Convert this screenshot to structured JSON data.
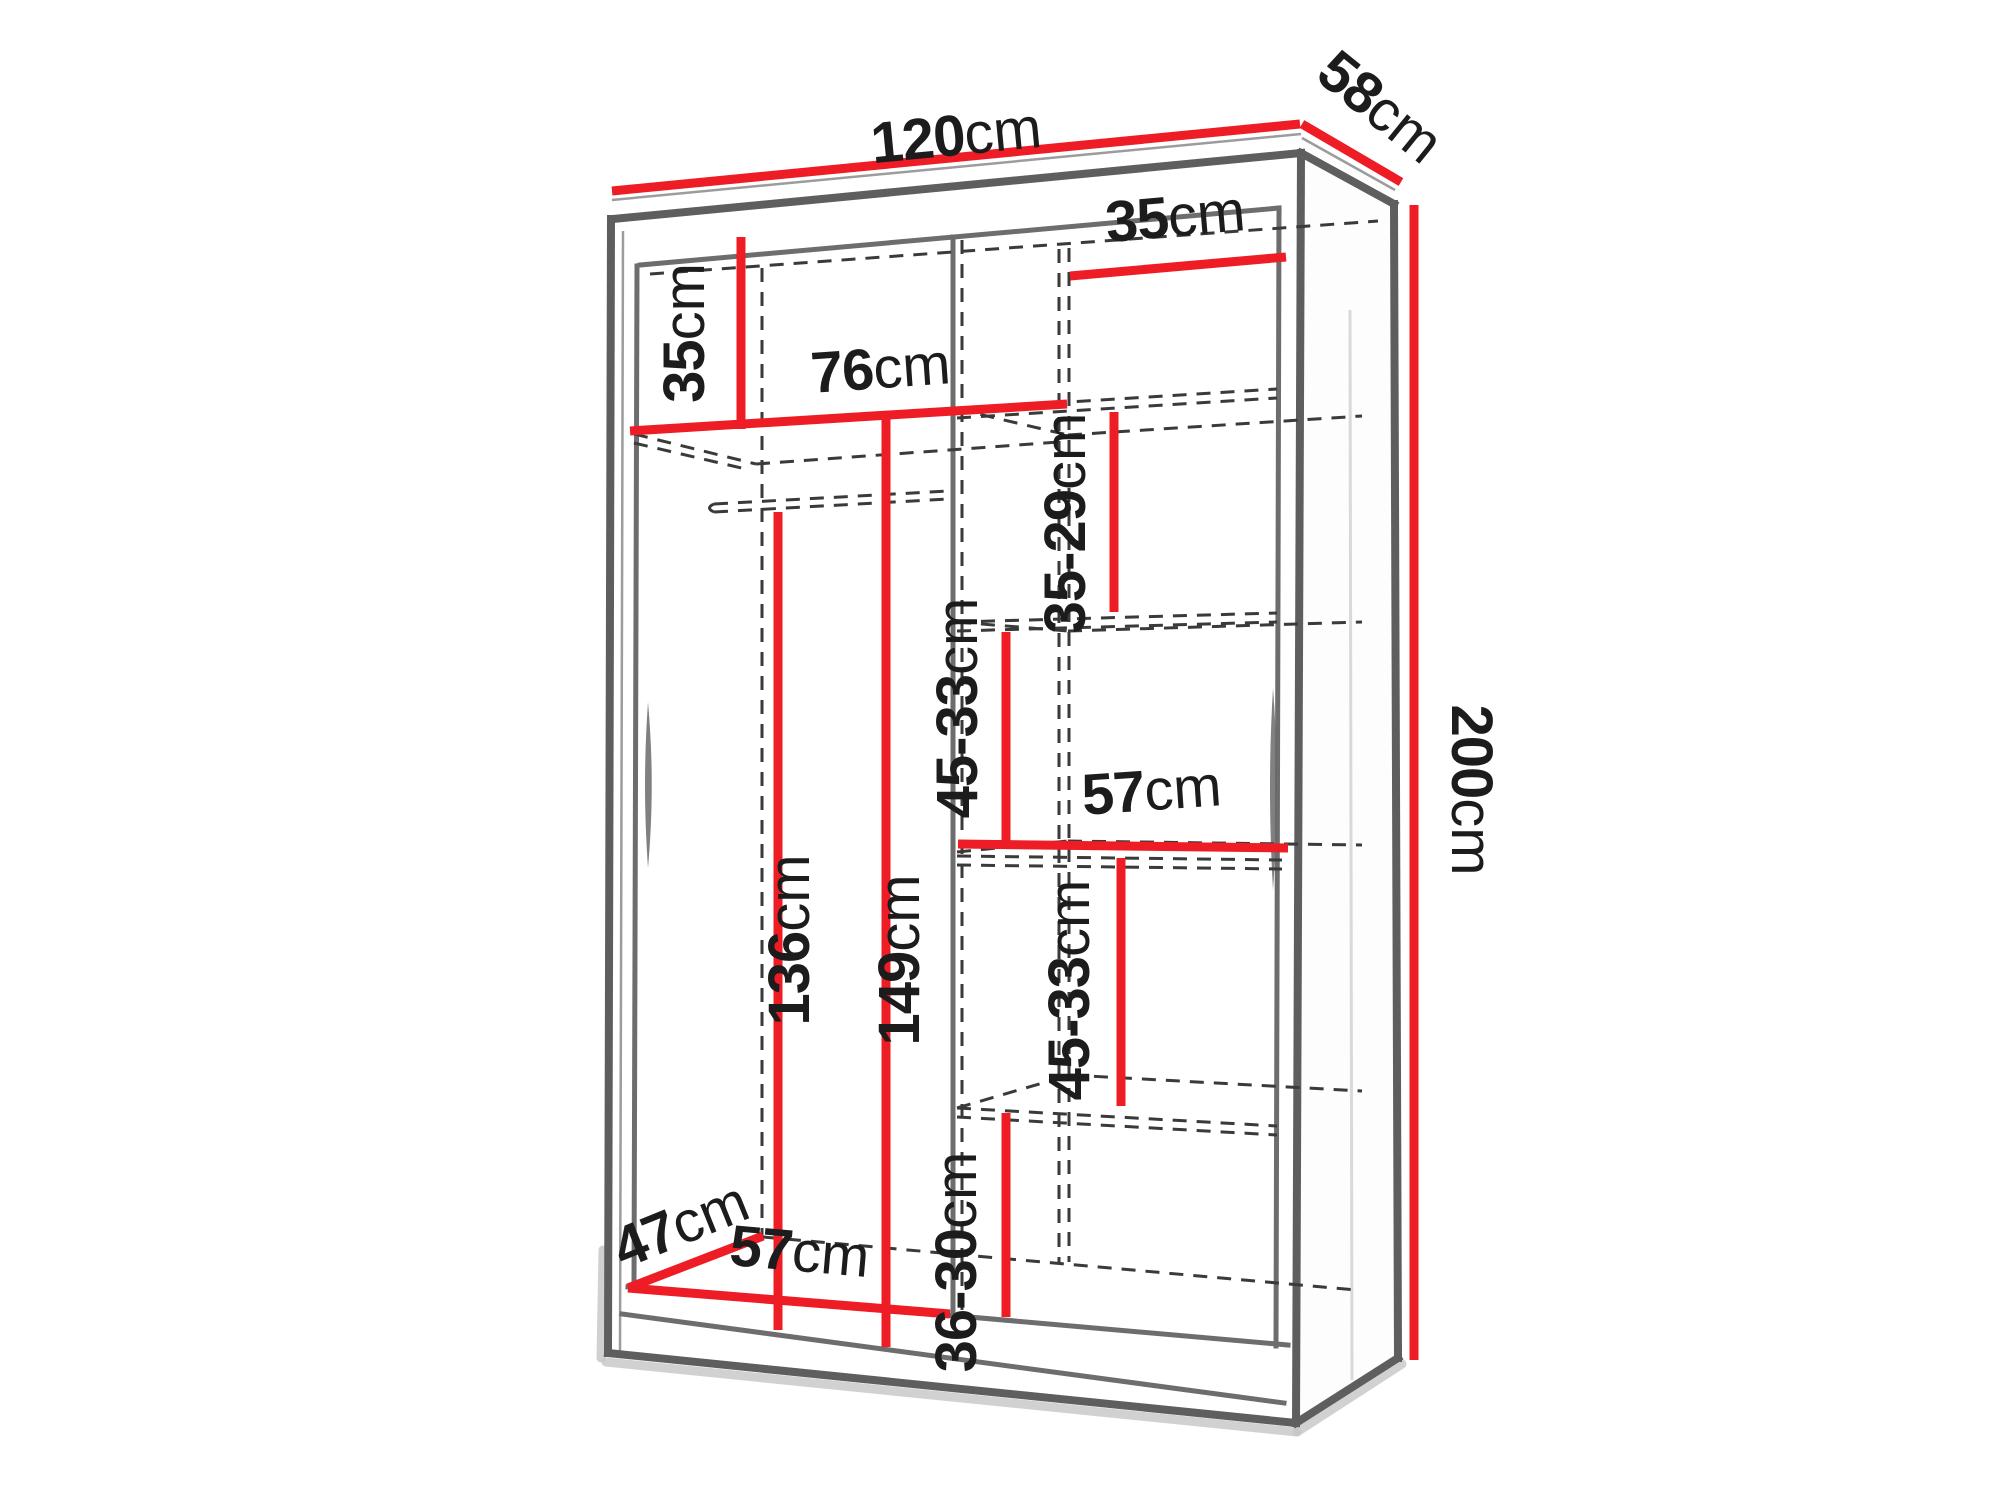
{
  "figure": {
    "subject": "wardrobe-interior-dimension-diagram",
    "unit": "cm",
    "colors": {
      "dimension_line": "#ee1c24",
      "structure_edge": "#5e5e5e",
      "hidden_edge_dashed": "#3a3a3a",
      "label_text": "#1c1c1c",
      "background": "#ffffff"
    }
  },
  "labels": [
    {
      "id": "width-top",
      "value": "120",
      "unit": "cm"
    },
    {
      "id": "depth-top",
      "value": "58",
      "unit": "cm"
    },
    {
      "id": "height-right",
      "value": "200",
      "unit": "cm"
    },
    {
      "id": "top-compartment-height",
      "value": "35",
      "unit": "cm"
    },
    {
      "id": "right-section-width",
      "value": "35",
      "unit": "cm"
    },
    {
      "id": "left-section-width",
      "value": "76",
      "unit": "cm"
    },
    {
      "id": "shelf-gap-top",
      "value": "35-29",
      "unit": "cm"
    },
    {
      "id": "shelf-gap-upper",
      "value": "45-33",
      "unit": "cm"
    },
    {
      "id": "middle-shelf-width",
      "value": "57",
      "unit": "cm"
    },
    {
      "id": "shelf-gap-lower",
      "value": "45-33",
      "unit": "cm"
    },
    {
      "id": "hanging-space-height",
      "value": "136",
      "unit": "cm"
    },
    {
      "id": "left-section-height",
      "value": "149",
      "unit": "cm"
    },
    {
      "id": "bottom-compartment-height",
      "value": "36-30",
      "unit": "cm"
    },
    {
      "id": "floor-depth",
      "value": "47",
      "unit": "cm"
    },
    {
      "id": "bottom-section-width",
      "value": "57",
      "unit": "cm"
    }
  ]
}
